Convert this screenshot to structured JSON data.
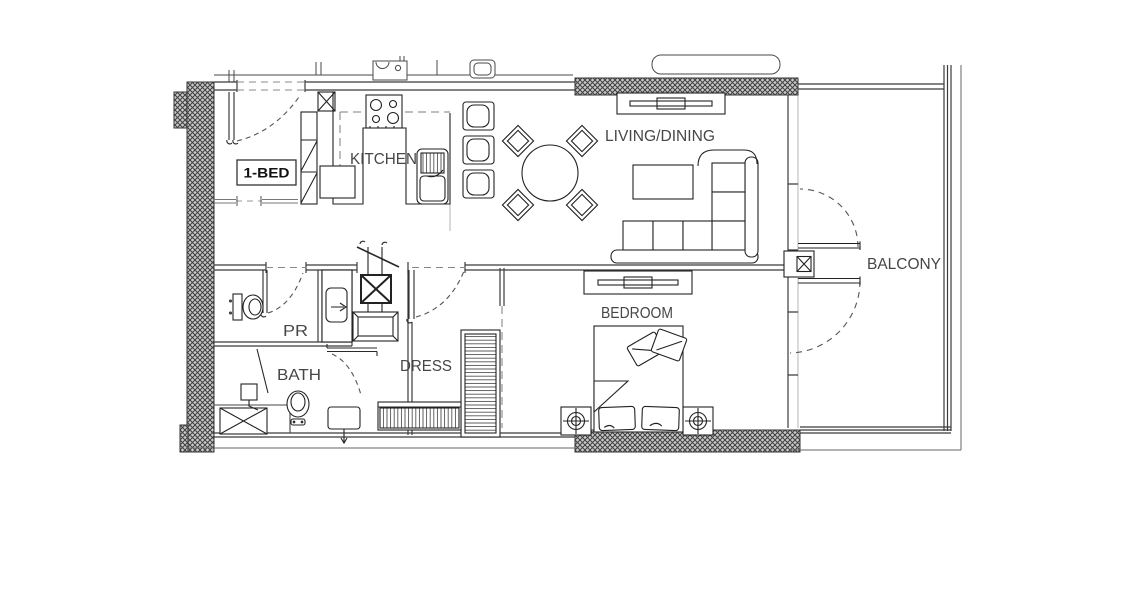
{
  "plan": {
    "unit_type_label": "1-BED",
    "rooms": {
      "kitchen": "KITCHEN",
      "living_dining": "LIVING/DINING",
      "balcony": "BALCONY",
      "bedroom": "BEDROOM",
      "dress": "DRESS",
      "bath": "BATH",
      "powder_room": "PR"
    },
    "fixtures": [
      "entry-door",
      "kitchen-island-sink",
      "cooktop",
      "bar-stools",
      "dining-table",
      "sofa",
      "coffee-table",
      "tv-console-living",
      "tv-console-bedroom",
      "double-bed",
      "nightstand-lamps",
      "wardrobes",
      "shower-tray",
      "bathtub",
      "toilets",
      "wash-basin",
      "shaft-duct",
      "ac-unit-balcony"
    ],
    "colors": {
      "background": "#ffffff",
      "line": "#2f2f2f",
      "wall_hatch": "#4a4a4a",
      "dashed_line": "#7a7a7a",
      "light_projection": "#b0b0b0"
    }
  }
}
